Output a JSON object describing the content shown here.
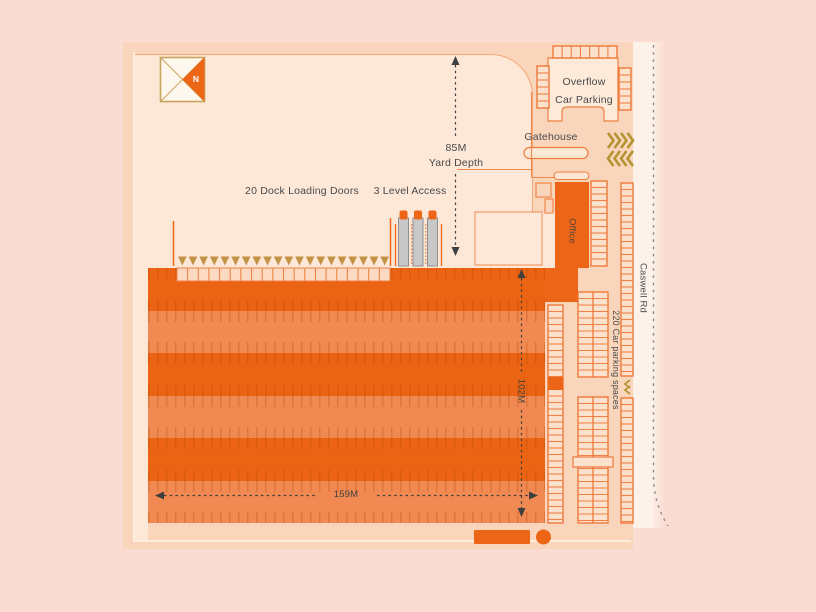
{
  "compass": {
    "icon": "compass-north-icon",
    "letter": "N"
  },
  "labels": {
    "dock_doors": "20 Dock Loading Doors",
    "level_access": "3 Level Access",
    "yard_depth_value": "85M",
    "yard_depth_name": "Yard Depth",
    "overflow_line1": "Overflow",
    "overflow_line2": "Car Parking",
    "gatehouse": "Gatehouse",
    "office": "Office",
    "road": "Caswell Rd",
    "car_spaces": "220 Car parking spaces",
    "dim_width": "159M",
    "dim_depth": "102M"
  },
  "counts": {
    "dock_doors": 20,
    "level_access_ramps": 3,
    "entry_chevrons_per_row": 4,
    "warehouse_bands": 6
  },
  "warehouse": {
    "bands": [
      "dark",
      "light",
      "dark",
      "light",
      "dark",
      "light"
    ]
  },
  "colors": {
    "background": "#fbdcd2",
    "plan": "#f9d5bc",
    "yard": "#fde7d7",
    "building_orange": "#ed6517",
    "band_dark": "#eb6413",
    "band_light": "#f08a52",
    "outline_orange": "#ed7230",
    "rung_orange": "#ee8145",
    "ladder_fill": "#fce1cc",
    "pale_fill": "#fdead9",
    "gold": "#b3922f",
    "dock_triangle_gold": "#c29245",
    "ramp_gray": "#c8c8c8",
    "compass_border": "#c9a45c",
    "dim_line": "#3f3f3f",
    "road_line": "#8c8c8c",
    "text": "#4a4a4a"
  }
}
